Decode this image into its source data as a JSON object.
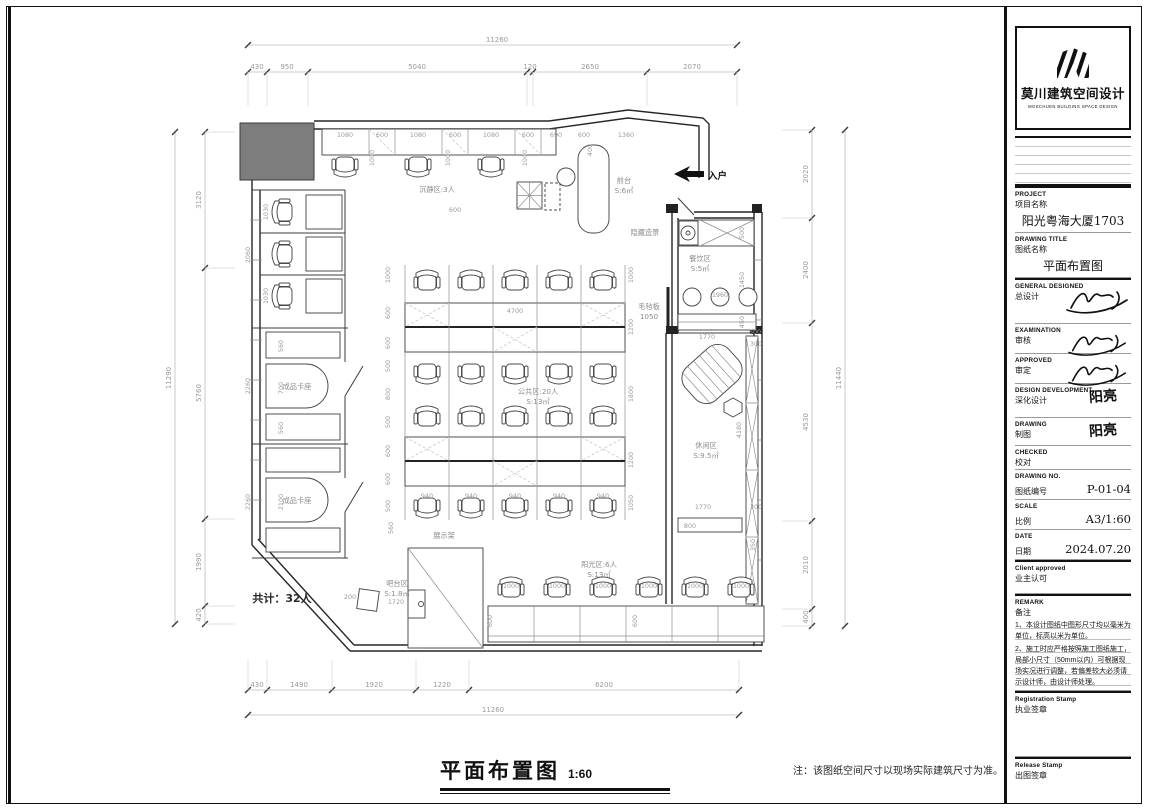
{
  "title_block": {
    "logo": {
      "name_cn": "莫川建筑空间设计",
      "name_en": "MOKCHUEN BUILDING SPACE DESIGN"
    },
    "rows": [
      {
        "en": "PROJECT",
        "cn": "项目名称",
        "value": "阳光粤海大厦1703"
      },
      {
        "en": "DRAWING TITLE",
        "cn": "图纸名称",
        "value": "平面布置图"
      },
      {
        "en": "GENERAL  DESIGNED",
        "cn": "总设计",
        "value": ""
      },
      {
        "en": "EXAMINATION",
        "cn": "审核",
        "value": ""
      },
      {
        "en": "APPROVED",
        "cn": "审定",
        "value": ""
      },
      {
        "en": "DESIGN DEVELOPMENT",
        "cn": "深化设计",
        "value": "阳亮"
      },
      {
        "en": "DRAWING",
        "cn": "制图",
        "value": "阳亮"
      },
      {
        "en": "CHECKED",
        "cn": "校对",
        "value": ""
      },
      {
        "en": "DRAWING NO.",
        "cn": "图纸编号",
        "value": "P-01-04"
      },
      {
        "en": "SCALE",
        "cn": "比例",
        "value": "A3/1:60"
      },
      {
        "en": "DATE",
        "cn": "日期",
        "value": "2024.07.20"
      },
      {
        "en": "Client approved",
        "cn": "业主认可",
        "value": ""
      }
    ],
    "remark": {
      "en": "REMARK",
      "cn": "备注",
      "notes": [
        "1、本设计图纸中图形尺寸均以毫米为单位，标高以米为单位。",
        "2、施工时应严格按照施工图纸施工，局部小尺寸（50mm以内）可根据现场实况进行调整，若偏差较大必须请示设计师，由设计师处理。"
      ]
    },
    "registration_stamp": {
      "en": "Registration Stamp",
      "cn": "执业签章"
    },
    "release_stamp": {
      "en": "Release Stamp",
      "cn": "出图签章"
    }
  },
  "footer": {
    "title": "平面布置图",
    "scale": "1:60",
    "note": "注：该图纸空间尺寸以现场实际建筑尺寸为准。"
  },
  "plan": {
    "entry_label": "入户",
    "zone_labels": [
      {
        "lines": [
          "沉静区:3人"
        ],
        "x": 437,
        "y": 192
      },
      {
        "lines": [
          "前台",
          "S:6㎡"
        ],
        "x": 624,
        "y": 183
      },
      {
        "lines": [
          "隐藏造景"
        ],
        "x": 645,
        "y": 235
      },
      {
        "lines": [
          "餐饮区",
          "S:5㎡"
        ],
        "x": 700,
        "y": 261
      },
      {
        "lines": [
          "毛毡板",
          "1050"
        ],
        "x": 649,
        "y": 309
      },
      {
        "lines": [
          "公共区:20人",
          "S:13㎡"
        ],
        "x": 538,
        "y": 394
      },
      {
        "lines": [
          "休闲区",
          "S:9.5㎡"
        ],
        "x": 706,
        "y": 448
      },
      {
        "lines": [
          "成品卡座"
        ],
        "x": 297,
        "y": 389
      },
      {
        "lines": [
          "成品卡座"
        ],
        "x": 297,
        "y": 503
      },
      {
        "lines": [
          "展示架"
        ],
        "x": 444,
        "y": 538
      },
      {
        "lines": [
          "吧台区",
          "S:1.8㎡"
        ],
        "x": 397,
        "y": 586
      },
      {
        "lines": [
          "阳光区:6人",
          "S:13㎡"
        ],
        "x": 599,
        "y": 567
      },
      {
        "lines": [
          "共计：32人"
        ],
        "x": 282,
        "y": 602,
        "cls": "zstrong"
      }
    ],
    "dim_chains": [
      {
        "o": "h",
        "pos": 45,
        "from": 248,
        "to": 737,
        "stub": 0,
        "ticks": [
          248,
          737
        ],
        "labels": [
          [
            "11260",
            497
          ]
        ]
      },
      {
        "o": "h",
        "pos": 72,
        "from": 248,
        "to": 737,
        "stub": 34,
        "ticks": [
          248,
          267,
          308,
          527,
          533,
          647,
          737
        ],
        "labels": [
          [
            "430",
            257
          ],
          [
            "950",
            287
          ],
          [
            "5040",
            417
          ],
          [
            "120",
            530
          ],
          [
            "2650",
            590
          ],
          [
            "2070",
            692
          ]
        ]
      },
      {
        "o": "h",
        "pos": 690,
        "from": 248,
        "to": 739,
        "stub": -30,
        "ticks": [
          248,
          267,
          332,
          416,
          469,
          739
        ],
        "labels": [
          [
            "430",
            257
          ],
          [
            "1490",
            299
          ],
          [
            "1920",
            374
          ],
          [
            "1220",
            442
          ],
          [
            "6200",
            604
          ]
        ]
      },
      {
        "o": "h",
        "pos": 715,
        "from": 248,
        "to": 739,
        "stub": 0,
        "ticks": [
          248,
          739
        ],
        "labels": [
          [
            "11260",
            493
          ]
        ]
      },
      {
        "o": "v",
        "pos": 175,
        "from": 132,
        "to": 624,
        "stub": 0,
        "ticks": [
          132,
          624
        ],
        "labels": [
          [
            "11290",
            378
          ]
        ]
      },
      {
        "o": "v",
        "pos": 205,
        "from": 132,
        "to": 624,
        "stub": 30,
        "ticks": [
          132,
          268,
          519,
          606,
          624
        ],
        "labels": [
          [
            "3120",
            200
          ],
          [
            "5760",
            393
          ],
          [
            "1990",
            562
          ],
          [
            "420",
            615
          ]
        ]
      },
      {
        "o": "v",
        "pos": 812,
        "from": 130,
        "to": 626,
        "stub": -30,
        "ticks": [
          130,
          218,
          323,
          521,
          609,
          626
        ],
        "labels": [
          [
            "2020",
            174
          ],
          [
            "2400",
            270
          ],
          [
            "4530",
            422
          ],
          [
            "2010",
            565
          ],
          [
            "400",
            617
          ]
        ]
      },
      {
        "o": "v",
        "pos": 845,
        "from": 130,
        "to": 626,
        "stub": 0,
        "ticks": [
          130,
          626
        ],
        "labels": [
          [
            "11440",
            378
          ]
        ]
      }
    ],
    "dim_labels": [
      [
        "1080",
        345,
        137
      ],
      [
        "600",
        382,
        137
      ],
      [
        "1080",
        418,
        137
      ],
      [
        "600",
        455,
        137
      ],
      [
        "1080",
        491,
        137
      ],
      [
        "600",
        528,
        137
      ],
      [
        "690",
        556,
        137
      ],
      [
        "600",
        584,
        137
      ],
      [
        "1360",
        626,
        137
      ],
      [
        "1000",
        374,
        158,
        -90
      ],
      [
        "1000",
        450,
        158,
        -90
      ],
      [
        "1000",
        527,
        158,
        -90
      ],
      [
        "400",
        592,
        150,
        -90
      ],
      [
        "600",
        455,
        212
      ],
      [
        "4700",
        515,
        313
      ],
      [
        "940",
        427,
        498
      ],
      [
        "940",
        471,
        498
      ],
      [
        "940",
        515,
        498
      ],
      [
        "940",
        559,
        498
      ],
      [
        "940",
        603,
        498
      ],
      [
        "1000",
        390,
        275,
        -90
      ],
      [
        "600",
        390,
        313,
        -90
      ],
      [
        "600",
        390,
        343,
        -90
      ],
      [
        "500",
        390,
        366,
        -90
      ],
      [
        "800",
        390,
        394,
        -90
      ],
      [
        "500",
        390,
        422,
        -90
      ],
      [
        "600",
        390,
        451,
        -90
      ],
      [
        "600",
        390,
        479,
        -90
      ],
      [
        "500",
        390,
        506,
        -90
      ],
      [
        "1000",
        633,
        275,
        -90
      ],
      [
        "1200",
        633,
        327,
        -90
      ],
      [
        "1800",
        633,
        394,
        -90
      ],
      [
        "1200",
        633,
        460,
        -90
      ],
      [
        "1050",
        633,
        503,
        -90
      ],
      [
        "2060",
        250,
        255,
        -90
      ],
      [
        "2260",
        250,
        386,
        -90
      ],
      [
        "2260",
        250,
        502,
        -90
      ],
      [
        "1030",
        268,
        212,
        -90
      ],
      [
        "1030",
        268,
        296,
        -90
      ],
      [
        "560",
        283,
        346,
        -90
      ],
      [
        "700",
        283,
        388,
        -90
      ],
      [
        "560",
        283,
        428,
        -90
      ],
      [
        "2100",
        283,
        502,
        -90
      ],
      [
        "500",
        744,
        233,
        -90
      ],
      [
        "1450",
        744,
        280,
        -90
      ],
      [
        "450",
        744,
        322,
        -90
      ],
      [
        "1960",
        720,
        297
      ],
      [
        "1770",
        707,
        339
      ],
      [
        "600",
        755,
        334
      ],
      [
        "300",
        756,
        346
      ],
      [
        "4180",
        741,
        430,
        -90
      ],
      [
        "1770",
        703,
        509
      ],
      [
        "300",
        756,
        509
      ],
      [
        "800",
        690,
        528
      ],
      [
        "350",
        755,
        545,
        -90
      ],
      [
        "1000",
        511,
        588
      ],
      [
        "1000",
        557,
        588
      ],
      [
        "1000",
        603,
        588
      ],
      [
        "1000",
        649,
        588
      ],
      [
        "1000",
        695,
        588
      ],
      [
        "1000",
        741,
        588
      ],
      [
        "600",
        492,
        621,
        -90
      ],
      [
        "600",
        637,
        621,
        -90
      ],
      [
        "1720",
        396,
        604
      ],
      [
        "200",
        350,
        599
      ],
      [
        "560",
        393,
        528,
        -90
      ]
    ]
  }
}
